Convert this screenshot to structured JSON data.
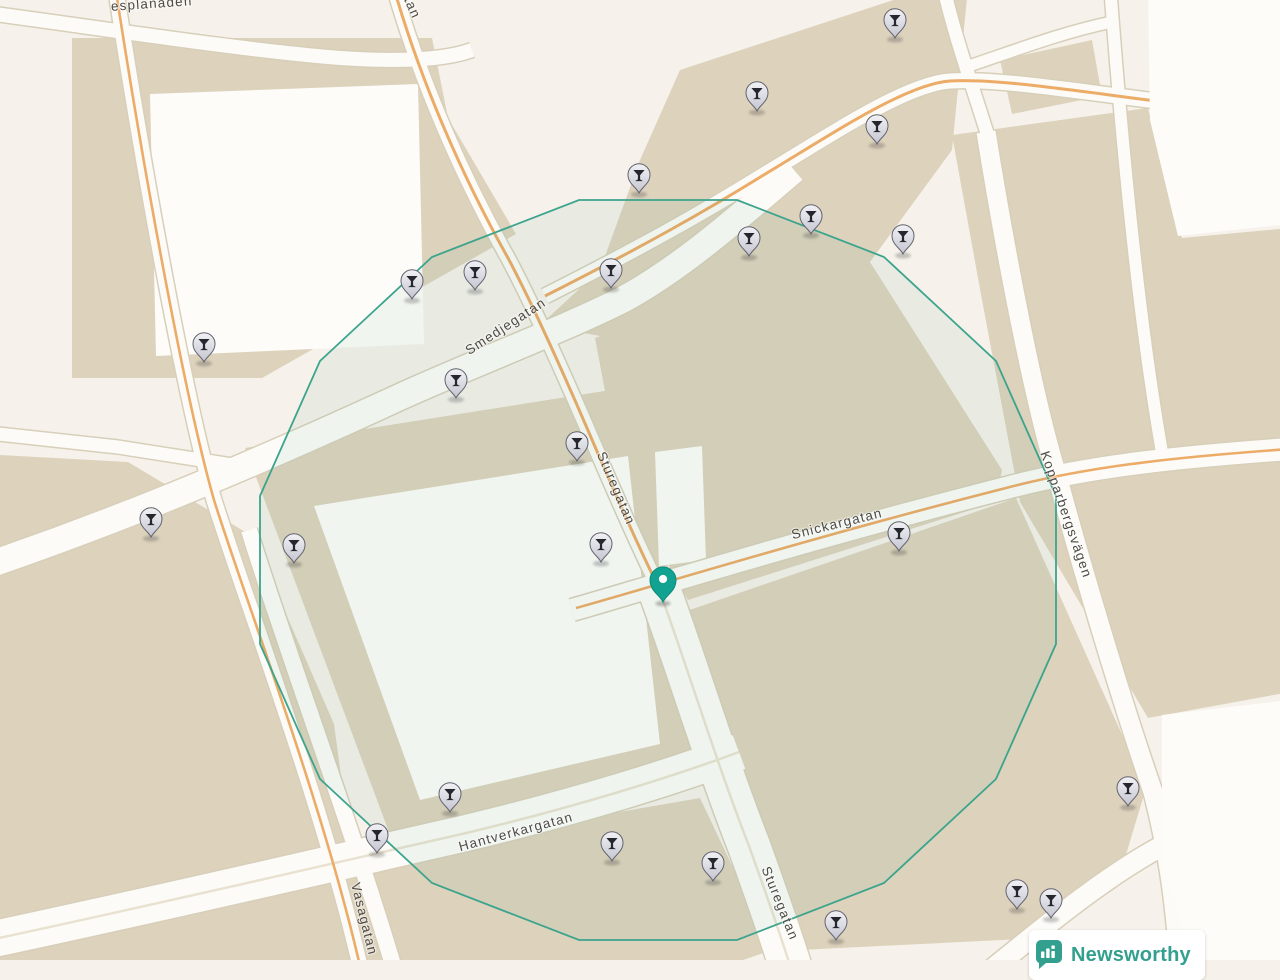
{
  "map": {
    "colors": {
      "background": "#f6f2eb",
      "building": "#ddd2bc",
      "building_light": "#fdfcf8",
      "road_fill": "#fcfbf7",
      "road_casing": "#d8cfba",
      "road_primary": "#ecab67",
      "road_center_line": "#e9e2d0",
      "radius_stroke": "#3ca48d",
      "radius_fill": "rgba(70,160,130,0.07)",
      "label": "#4e4a45",
      "marker": "#12a291",
      "pin_fill_top": "#f1f1f5",
      "pin_fill_bottom": "#c5c5d1",
      "pin_stroke": "#63636f",
      "pin_glyph": "#26262e",
      "brand": "#33a08f"
    },
    "street_labels": [
      {
        "id": "esplanaden",
        "text": "esplanaden",
        "x": 152,
        "y": 8,
        "rotation": -4,
        "anchor": "middle"
      },
      {
        "id": "sturegatan-top",
        "text": "Sturegatan",
        "x": 397,
        "y": -16,
        "rotation": 66,
        "anchor": "start"
      },
      {
        "id": "smedjegatan",
        "text": "Smedjegatan",
        "x": 508,
        "y": 330,
        "rotation": -33,
        "anchor": "middle"
      },
      {
        "id": "sturegatan-mid",
        "text": "Sturegatan",
        "x": 612,
        "y": 490,
        "rotation": 67,
        "anchor": "middle"
      },
      {
        "id": "snickargatan",
        "text": "Snickargatan",
        "x": 838,
        "y": 528,
        "rotation": -14,
        "anchor": "middle"
      },
      {
        "id": "kopparbergsvagen",
        "text": "Kopparbergsvägen",
        "x": 1062,
        "y": 516,
        "rotation": 71,
        "anchor": "middle"
      },
      {
        "id": "hantverkargatan",
        "text": "Hantverkargatan",
        "x": 517,
        "y": 836,
        "rotation": -15,
        "anchor": "middle"
      },
      {
        "id": "vasagatan",
        "text": "Vasagatan",
        "x": 360,
        "y": 920,
        "rotation": 76,
        "anchor": "start"
      },
      {
        "id": "sturegatan-bottom",
        "text": "Sturegatan",
        "x": 776,
        "y": 905,
        "rotation": 68,
        "anchor": "middle"
      }
    ],
    "venue_pin_icon": "cocktail-glass-icon",
    "venue_pins": [
      {
        "x": 895,
        "y": 22
      },
      {
        "x": 757,
        "y": 95
      },
      {
        "x": 877,
        "y": 128
      },
      {
        "x": 639,
        "y": 177
      },
      {
        "x": 811,
        "y": 218
      },
      {
        "x": 749,
        "y": 240
      },
      {
        "x": 903,
        "y": 238
      },
      {
        "x": 475,
        "y": 274
      },
      {
        "x": 611,
        "y": 272
      },
      {
        "x": 412,
        "y": 283
      },
      {
        "x": 204,
        "y": 346
      },
      {
        "x": 456,
        "y": 382
      },
      {
        "x": 577,
        "y": 445
      },
      {
        "x": 151,
        "y": 521
      },
      {
        "x": 294,
        "y": 547
      },
      {
        "x": 601,
        "y": 546
      },
      {
        "x": 899,
        "y": 535
      },
      {
        "x": 1128,
        "y": 790
      },
      {
        "x": 450,
        "y": 796
      },
      {
        "x": 377,
        "y": 837
      },
      {
        "x": 612,
        "y": 845
      },
      {
        "x": 713,
        "y": 865
      },
      {
        "x": 1017,
        "y": 893
      },
      {
        "x": 1051,
        "y": 902
      },
      {
        "x": 836,
        "y": 924
      }
    ],
    "selected_marker": {
      "x": 663,
      "y": 583
    }
  },
  "branding": {
    "logo_text": "Newsworthy",
    "logo_icon": "bar-chart-badge-icon",
    "logo_color": "#33a08f"
  }
}
